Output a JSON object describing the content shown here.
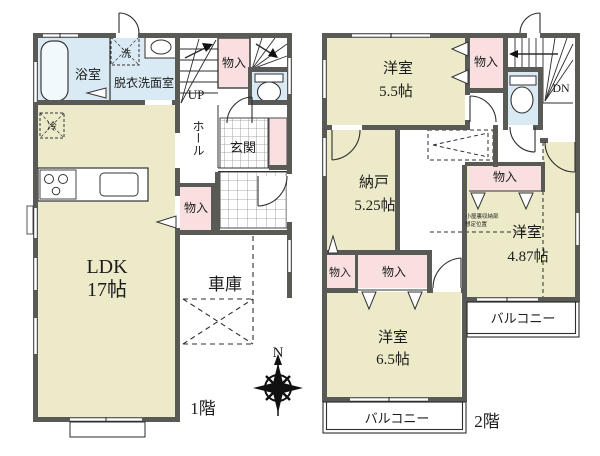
{
  "title": "間取り図",
  "floor1": {
    "floor_label": "1階",
    "bath": "浴室",
    "washroom": "脱衣洗面室",
    "washer": "洗",
    "fridge": "冷",
    "stairs_up": "UP",
    "closet_stairs": "物入",
    "hall": "ホール",
    "entrance": "玄関",
    "closet_hall": "物入",
    "ldk_name": "LDK",
    "ldk_size": "17帖",
    "garage": "車庫"
  },
  "floor2": {
    "floor_label": "2階",
    "room1_name": "洋室",
    "room1_size": "5.5帖",
    "closet_top": "物入",
    "stairs_down": "DN",
    "storage_name": "納戸",
    "storage_size": "5.25帖",
    "closet_right": "物入",
    "room2_name": "洋室",
    "room2_size": "4.87帖",
    "closet_left_a": "物入",
    "closet_left_b": "物入",
    "room3_name": "洋室",
    "room3_size": "6.5帖",
    "balcony_bottom": "バルコニー",
    "balcony_right": "バルコニー",
    "attic_note_line1": "小屋裏収納部",
    "attic_note_line2": "想定位置"
  },
  "compass": {
    "north_label": "N"
  },
  "colors": {
    "room_beige": "#ECEAC8",
    "closet_pink": "#F9DFDF",
    "wet_blue": "#D9EAF4",
    "wall_dark": "#595956",
    "note_brown": "#7E5C3F"
  }
}
